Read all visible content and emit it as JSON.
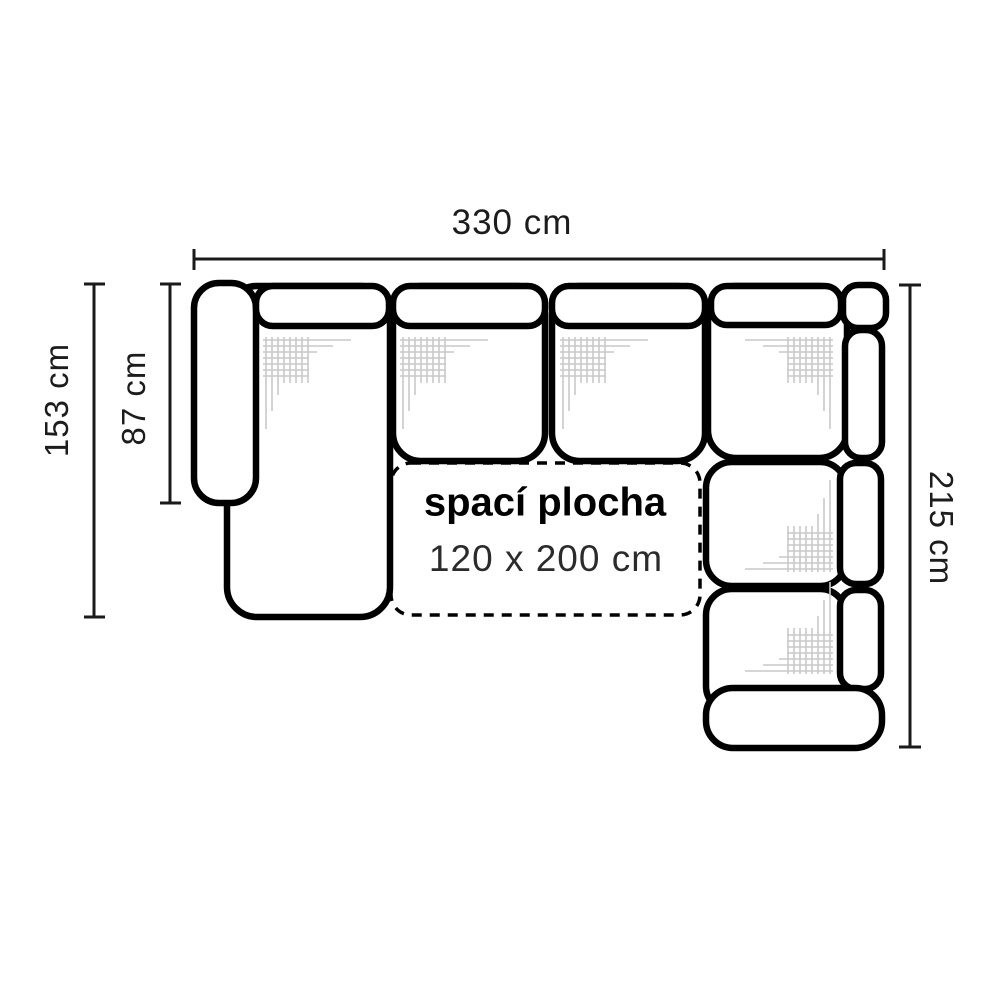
{
  "diagram": {
    "type": "corner-sofa-top-view-dimension-drawing",
    "dimensions": {
      "width_top": "330 cm",
      "depth_left_total": "153 cm",
      "depth_left_seat": "87 cm",
      "depth_right_total": "215 cm"
    },
    "sleeping_area": {
      "title": "spací plocha",
      "size": "120 x 200 cm"
    },
    "colors": {
      "outline": "#000000",
      "dimension_lines": "#1a1a1a",
      "text": "#1c1c1c",
      "hatch": "#c9c9c9",
      "background": "#ffffff"
    }
  }
}
